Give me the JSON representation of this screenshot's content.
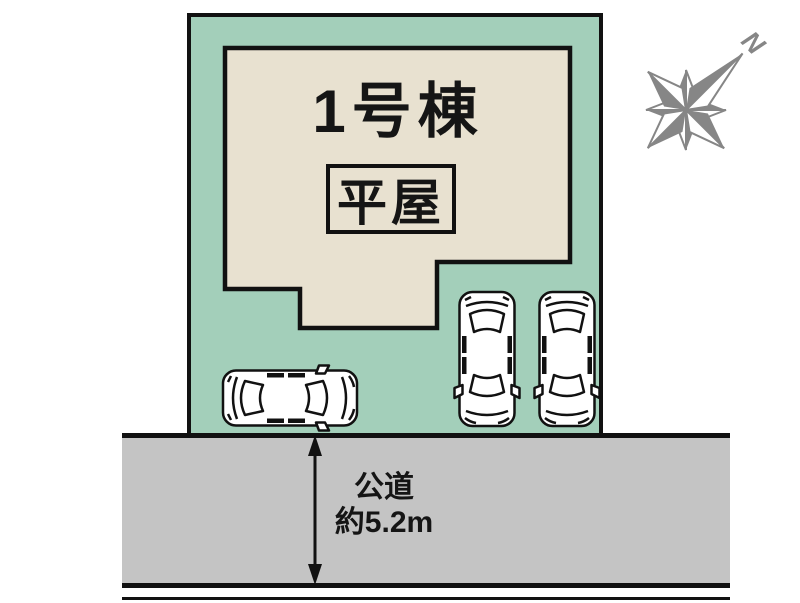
{
  "plot": {
    "building": {
      "name": "1号棟",
      "badge": "平屋"
    }
  },
  "road": {
    "name": "公道",
    "width": "約5.2m"
  },
  "compass": {
    "north": "N"
  },
  "colors": {
    "plot_green": "#a3cfba",
    "building_beige": "#e8e1d0",
    "road_gray": "#c4c4c4",
    "compass_gray": "#868686",
    "line_black": "#111111"
  }
}
